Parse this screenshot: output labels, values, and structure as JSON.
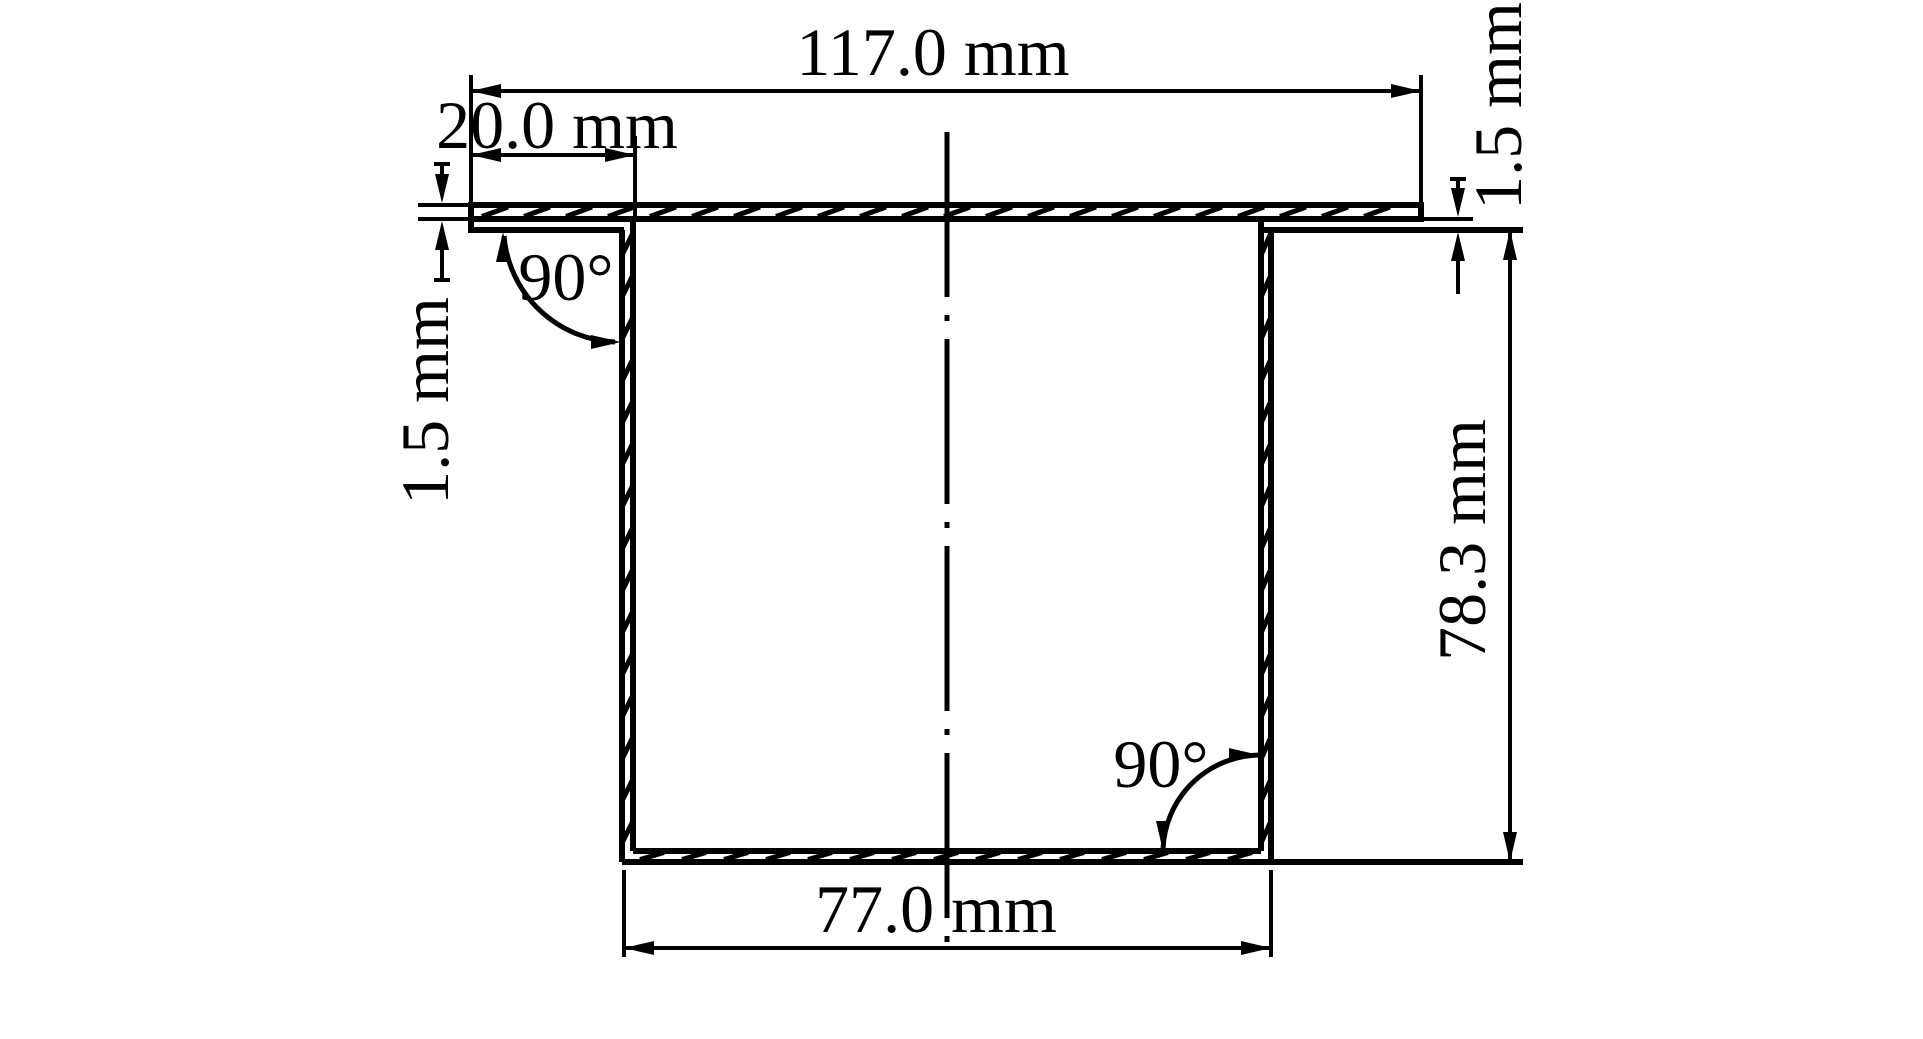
{
  "drawing": {
    "kind": "engineering cross-section drawing",
    "part": "flanged deep-drawn cup cross-section",
    "background_color": "#ffffff",
    "ink_color": "#000000",
    "labels": {
      "flange_width": "117.0 mm",
      "flange_overhang": "20.0 mm",
      "thickness_left": "1.5 mm",
      "thickness_right": "1.5 mm",
      "cup_depth": "78.3 mm",
      "bottom_width": "77.0 mm",
      "angle_top_left": "90°",
      "angle_bottom_right": "90°"
    }
  }
}
